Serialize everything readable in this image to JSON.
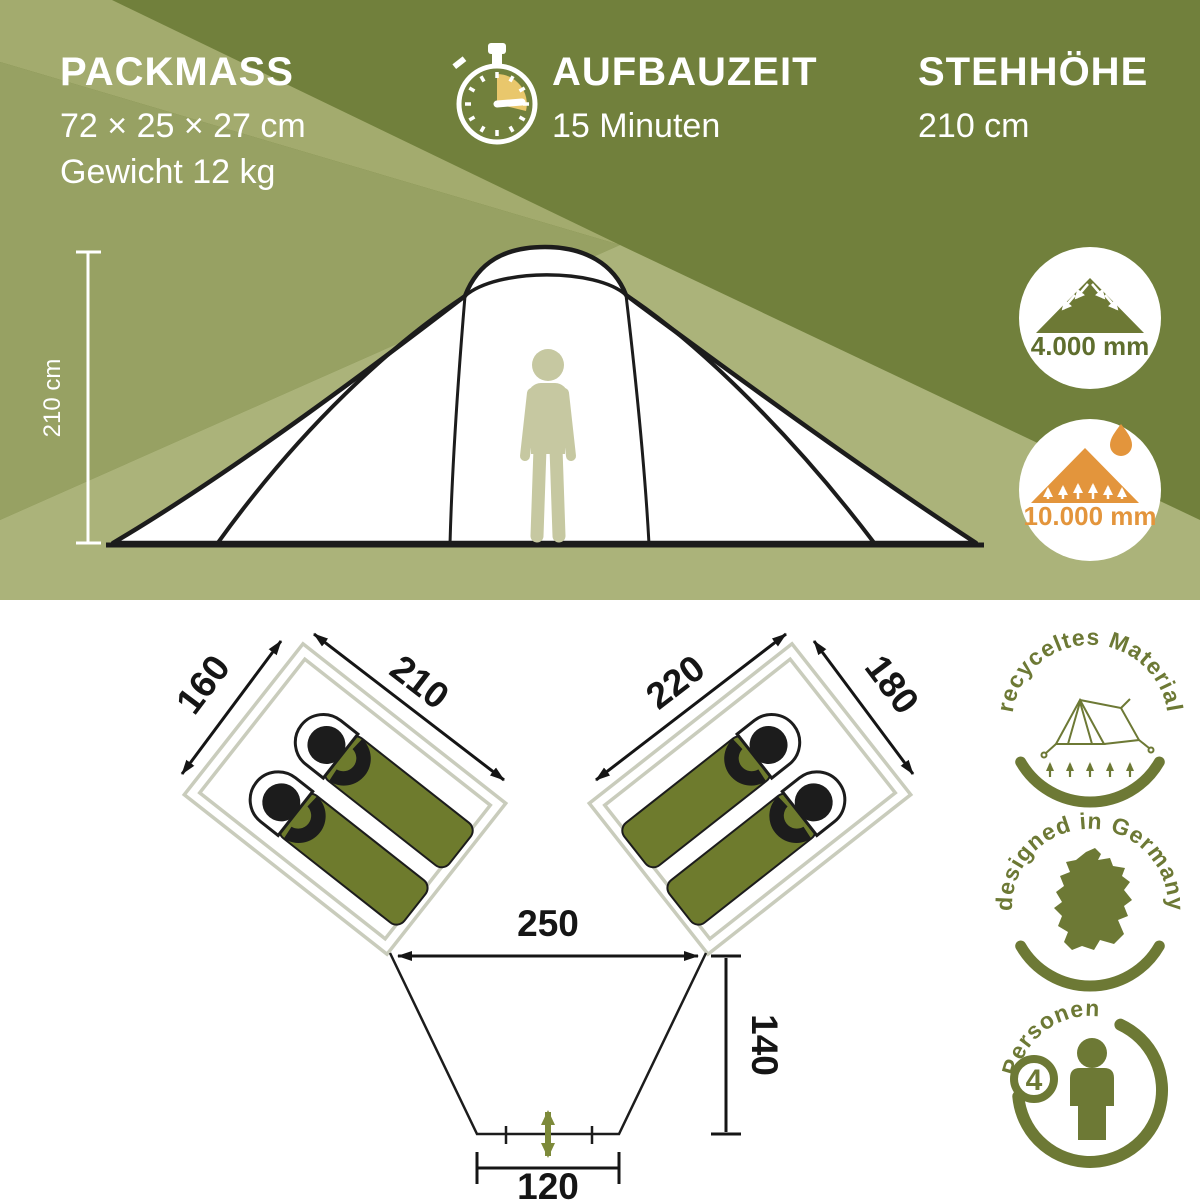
{
  "header": {
    "packmass": {
      "title": "PACKMASS",
      "size": "72 × 25 × 27 cm",
      "weight": "Gewicht 12 kg"
    },
    "aufbauzeit": {
      "title": "AUFBAUZEIT",
      "value": "15 Minuten"
    },
    "stehhoehe": {
      "title": "STEHHÖHE",
      "value": "210 cm"
    }
  },
  "tent_front": {
    "height_label": "210 cm"
  },
  "badges": {
    "water_column_outer": "4.000 mm",
    "water_column_floor": "10.000 mm"
  },
  "floorplan": {
    "left_cabin": {
      "side": "160",
      "front": "210"
    },
    "right_cabin": {
      "front": "220",
      "side": "180"
    },
    "living_width": "250",
    "living_depth": "140",
    "entrance_width": "120"
  },
  "seals": {
    "recycled": "recyceltes Material",
    "designed": "designed in Germany",
    "persons_label": "Personen",
    "persons_count": "4"
  },
  "colors": {
    "olive_dark": "#71803c",
    "olive_medium": "#97a163",
    "olive_light": "#abb37a",
    "seal_olive": "#6d7935",
    "bag_olive": "#6e7b2d",
    "accent_orange": "#e3953c",
    "timer_sand": "#e9c76c",
    "figure_beige": "#c6c8a1"
  }
}
